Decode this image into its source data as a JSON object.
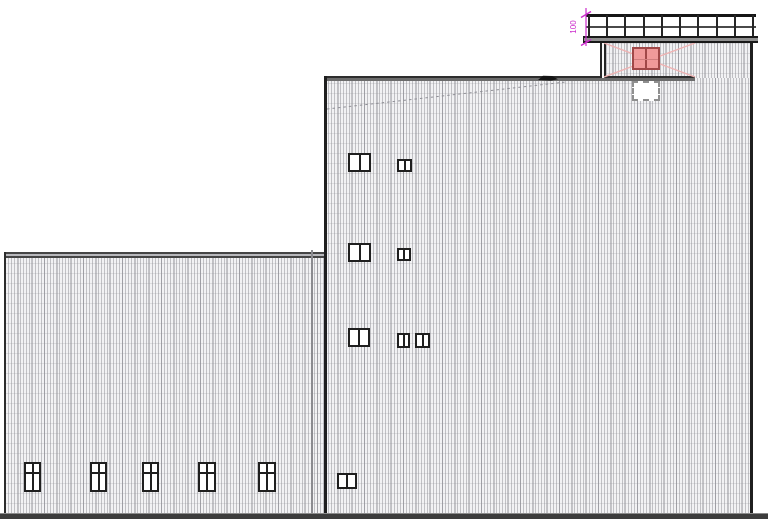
{
  "drawing": {
    "type": "architectural-elevation",
    "annotation": {
      "dimension_label": "100"
    },
    "colors": {
      "outline": "#1f1f1f",
      "facade_base": "#f2f2f4",
      "magenta": "#cc2bcc",
      "pink_fill": "#f09a9a",
      "pink_border": "#a04848",
      "pink_cross": "#eeb2b2",
      "ground": "#3c3c3c"
    },
    "left_building": {
      "window_style": "4-pane-cross",
      "windows": [
        {
          "x": 24,
          "y": 462,
          "w": 17,
          "h": 30
        },
        {
          "x": 90,
          "y": 462,
          "w": 17,
          "h": 30
        },
        {
          "x": 142,
          "y": 462,
          "w": 17,
          "h": 30
        },
        {
          "x": 198,
          "y": 462,
          "w": 18,
          "h": 30
        },
        {
          "x": 258,
          "y": 462,
          "w": 18,
          "h": 30
        }
      ]
    },
    "tall_building": {
      "window_style": "2-pane",
      "windows": [
        {
          "x": 348,
          "y": 153,
          "w": 23,
          "h": 19
        },
        {
          "x": 397,
          "y": 159,
          "w": 15,
          "h": 13
        },
        {
          "x": 348,
          "y": 243,
          "w": 23,
          "h": 19
        },
        {
          "x": 397,
          "y": 248,
          "w": 14,
          "h": 13
        },
        {
          "x": 348,
          "y": 328,
          "w": 22,
          "h": 19
        },
        {
          "x": 397,
          "y": 333,
          "w": 13,
          "h": 15
        },
        {
          "x": 415,
          "y": 333,
          "w": 15,
          "h": 15
        },
        {
          "x": 337,
          "y": 473,
          "w": 20,
          "h": 16
        }
      ],
      "roof_deck": {
        "guardrail_post_count": 10
      }
    }
  }
}
